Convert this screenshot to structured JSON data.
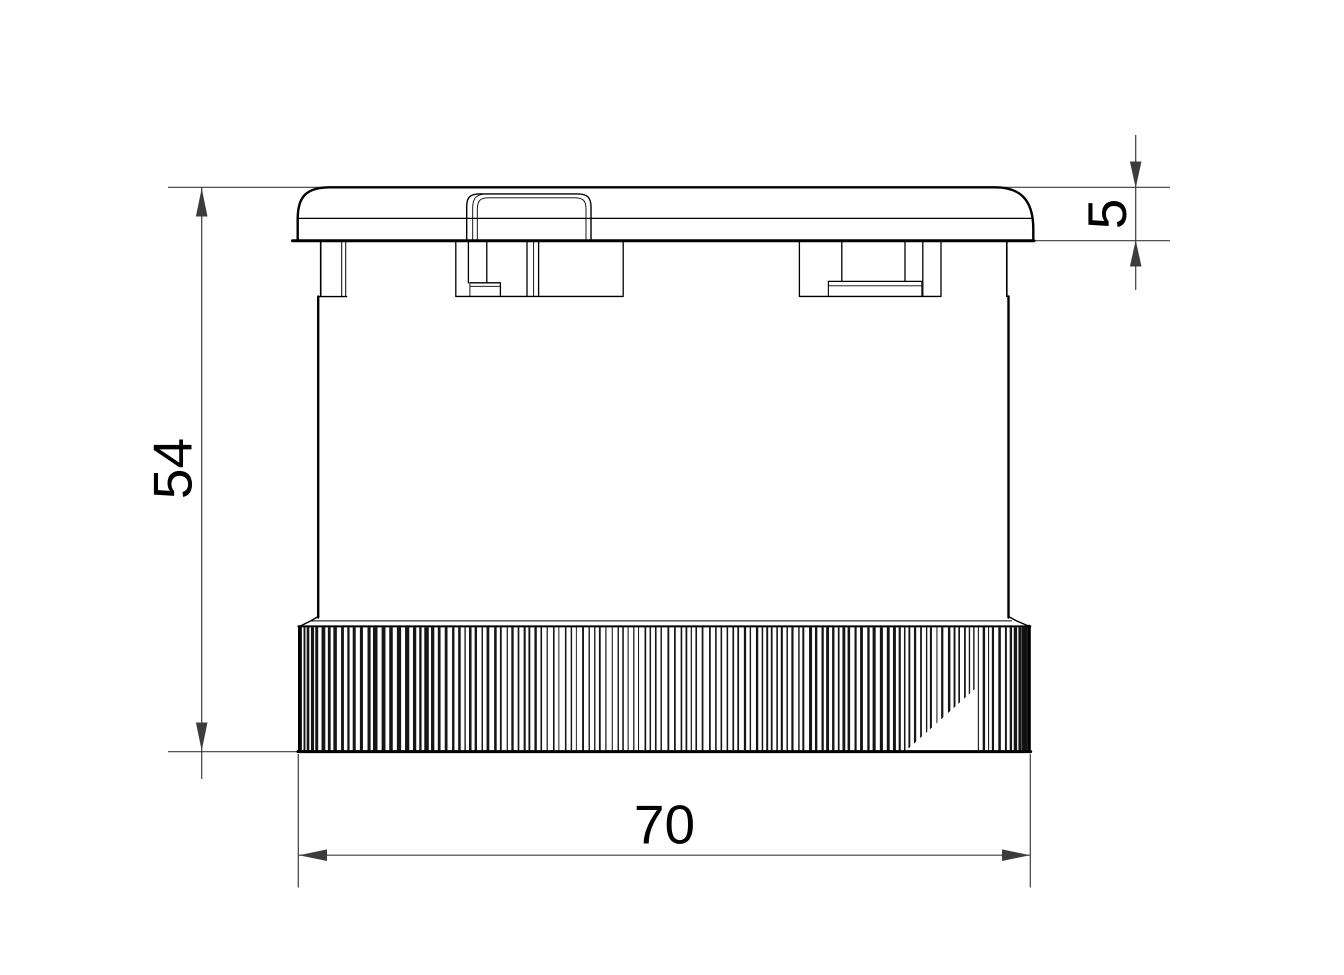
{
  "drawing": {
    "kind": "technical dimension drawing, front view",
    "dimensions": {
      "overall_height": {
        "value": "54",
        "orientation": "vertical-left"
      },
      "cap_height": {
        "value": "5",
        "orientation": "vertical-right"
      },
      "overall_width": {
        "value": "70",
        "orientation": "horizontal-bottom"
      }
    },
    "colors": {
      "background": "#ffffff",
      "part_line": "#000000",
      "dimension_line": "#3c3c3c",
      "text": "#000000"
    }
  }
}
